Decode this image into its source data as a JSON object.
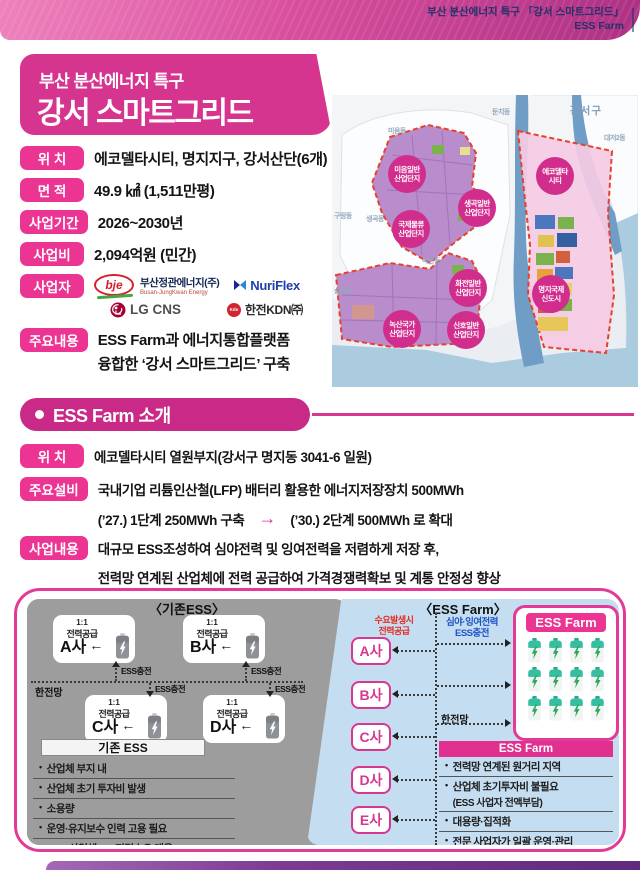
{
  "banner": {
    "line1": "부산 분산에너지 특구 「강서 스마트그리드」",
    "line2": "ESS Farm"
  },
  "title": {
    "subtitle": "부산 분산에너지 특구",
    "main": "강서 스마트그리드"
  },
  "overview": {
    "rows": [
      {
        "label": "위 치",
        "value": "에코델타시티, 명지지구, 강서산단(6개)"
      },
      {
        "label": "면 적",
        "value": "49.9 ㎢ (1,511만평)"
      },
      {
        "label": "사업기간",
        "value": "2026~2030년"
      },
      {
        "label": "사업비",
        "value": "2,094억원 (민간)"
      }
    ],
    "operators": {
      "label": "사업자",
      "bje_text": "bje",
      "bje_name": "부산정관에너지(주)",
      "bje_sub": "Busan-JungKwan Energy",
      "nuriflex": "NuriFlex",
      "lgcns": "LG CNS",
      "kdn": "한전KDN㈜"
    },
    "content": {
      "label": "주요내용",
      "line1": "ESS Farm과 에너지통합플랫폼",
      "line2": "융합한 ‘강서 스마트그리드’ 구축"
    }
  },
  "map": {
    "district": "강서구",
    "towns": [
      "미음동",
      "둔치동",
      "대저2동",
      "구랑동",
      "생곡동",
      "녹산동",
      "송정동"
    ],
    "zones": [
      {
        "line1": "미음일반",
        "line2": "산업단지"
      },
      {
        "line1": "생곡일반",
        "line2": "산업단지"
      },
      {
        "line1": "국제물류",
        "line2": "산업단지"
      },
      {
        "line1": "에코델타",
        "line2": "시티"
      },
      {
        "line1": "화전일반",
        "line2": "산업단지"
      },
      {
        "line1": "녹산국가",
        "line2": "산업단지"
      },
      {
        "line1": "신호일반",
        "line2": "산업단지"
      },
      {
        "line1": "명지국제",
        "line2": "신도시"
      }
    ]
  },
  "intro": {
    "section_title": "ESS Farm 소개",
    "location": {
      "label": "위 치",
      "value": "에코델타시티 열원부지(강서구 명지동 3041-6 일원)"
    },
    "facility": {
      "label": "주요설비",
      "line1": "국내기업 리튬인산철(LFP) 배터리 활용한 에너지저장장치 500MWh",
      "phase1": "(’27.) 1단계 250MWh 구축",
      "arrow": "→",
      "phase2": "(’30.) 2단계 500MWh 로 확대"
    },
    "business": {
      "label": "사업내용",
      "line1": "대규모 ESS조성하여 심야전력 및 잉여전력을 저렴하게 저장 후,",
      "line2": "전력망 연계된 산업체에 전력 공급하여 가격경쟁력확보 및 계통 안정성 향상"
    }
  },
  "diagram": {
    "existing": {
      "title": "〈기존ESS〉",
      "supply1": "1:1",
      "supply2": "전력공급",
      "arrow": "←",
      "companies": [
        "A사",
        "B사",
        "C사",
        "D사"
      ],
      "charge": "ESS충전",
      "grid": "한전망",
      "list_header": "기존 ESS",
      "items": [
        "산업체 부지 내",
        "산업체 초기 투자비 발생",
        "소용량",
        "운영·유지보수 인력 고용 필요",
        "ESS-산업체 1:1 전력수요 대응"
      ]
    },
    "farm": {
      "title": "〈ESS Farm〉",
      "badge": "ESS Farm",
      "demand1": "수요발생시",
      "demand2": "전력공급",
      "charge1": "심야·잉여전력",
      "charge2": "ESS충전",
      "grid": "한전망",
      "companies": [
        "A사",
        "B사",
        "C사",
        "D사",
        "E사"
      ],
      "list_header": "ESS Farm",
      "items": [
        {
          "text": "전력망 연계된 원거리 지역",
          "sub": ""
        },
        {
          "text": "산업체 초기투자비 불필요",
          "sub": "(ESS 사업자 전액부담)"
        },
        {
          "text": "대용량·집적화",
          "sub": ""
        },
        {
          "text": "전문 사업자가 일괄 운영·관리",
          "sub": ""
        },
        {
          "text": "다수산업체 전력수요 동시관리",
          "sub": ""
        }
      ]
    }
  },
  "colors": {
    "magenta": "#d5358f",
    "badge_pink": "#ec3493",
    "navy": "#233069",
    "red_label": "#e8281e",
    "blue_label": "#1d55c4",
    "gray_panel": "#9d9d9d",
    "blue_panel": "#c5ddf1",
    "battery_green": "#35bfa0",
    "zone_dashed": "#e8402a"
  }
}
